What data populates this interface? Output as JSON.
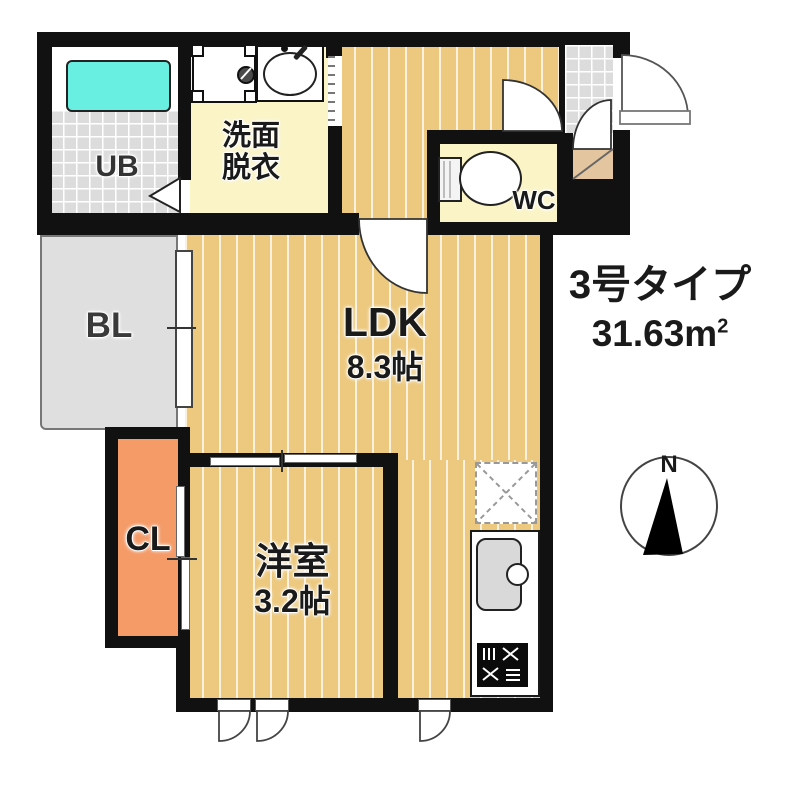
{
  "plan": {
    "type_title": "3号タイプ",
    "area_value": "31.63m",
    "area_sup": "2",
    "rooms": {
      "ub": "UB",
      "washroom_l1": "洗面",
      "washroom_l2": "脱衣",
      "wc": "WC",
      "ldk_name": "LDK",
      "ldk_size": "8.3帖",
      "balcony": "BL",
      "closet": "CL",
      "western_name": "洋室",
      "western_size": "3.2帖"
    },
    "compass_label": "N",
    "colors": {
      "wall": "#111111",
      "flooring": "#ECC97E",
      "wet": "#FAF4C6",
      "tile": "#DCDCDC",
      "balcony": "#DFDFDF",
      "closet": "#F49B68",
      "bathtub": "#68EFE2",
      "step": "#E3C5A0"
    }
  }
}
